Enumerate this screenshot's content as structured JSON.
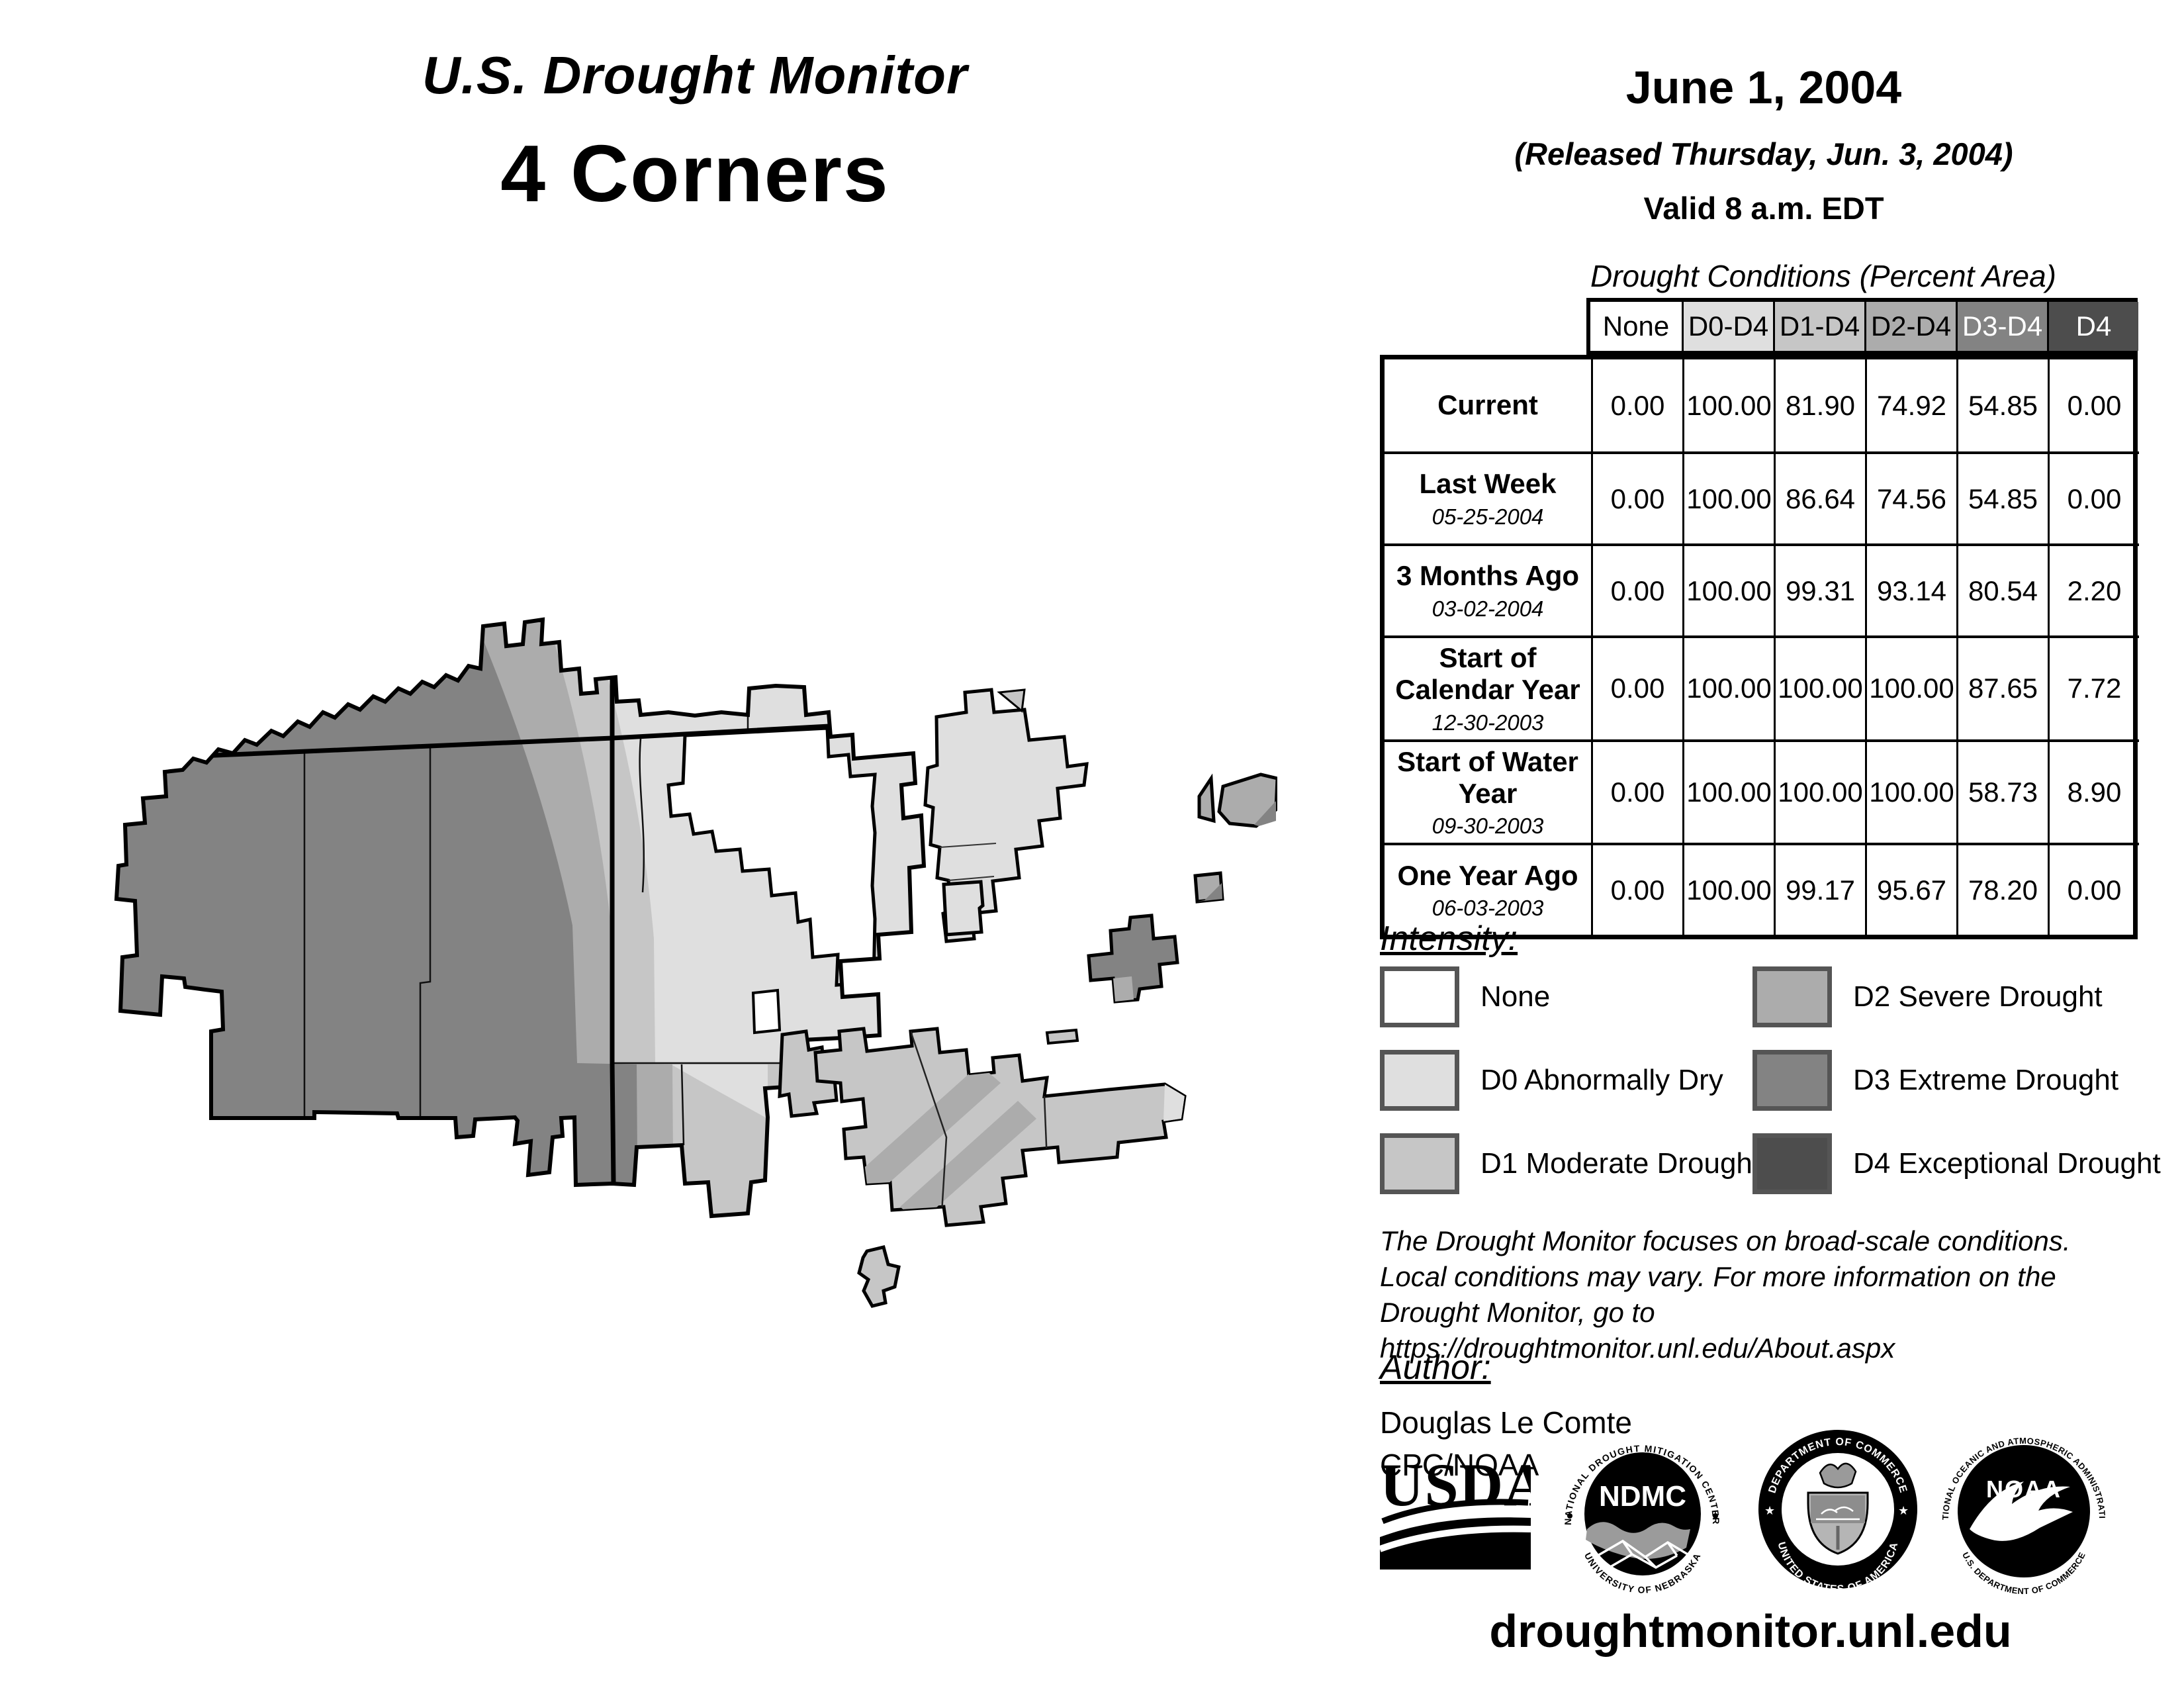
{
  "header": {
    "monitor_title": "U.S. Drought Monitor",
    "region": "4 Corners",
    "date": "June 1, 2004",
    "released": "(Released Thursday, Jun. 3, 2004)",
    "valid": "Valid 8 a.m. EDT"
  },
  "table": {
    "title": "Drought Conditions (Percent Area)",
    "columns": [
      "None",
      "D0-D4",
      "D1-D4",
      "D2-D4",
      "D3-D4",
      "D4"
    ],
    "rows": [
      {
        "label": "Current",
        "date": "",
        "values": [
          "0.00",
          "100.00",
          "81.90",
          "74.92",
          "54.85",
          "0.00"
        ]
      },
      {
        "label": "Last Week",
        "date": "05-25-2004",
        "values": [
          "0.00",
          "100.00",
          "86.64",
          "74.56",
          "54.85",
          "0.00"
        ]
      },
      {
        "label": "3 Months Ago",
        "date": "03-02-2004",
        "values": [
          "0.00",
          "100.00",
          "99.31",
          "93.14",
          "80.54",
          "2.20"
        ]
      },
      {
        "label": "Start of Calendar Year",
        "date": "12-30-2003",
        "values": [
          "0.00",
          "100.00",
          "100.00",
          "100.00",
          "87.65",
          "7.72"
        ]
      },
      {
        "label": "Start of Water Year",
        "date": "09-30-2003",
        "values": [
          "0.00",
          "100.00",
          "100.00",
          "100.00",
          "58.73",
          "8.90"
        ]
      },
      {
        "label": "One Year Ago",
        "date": "06-03-2003",
        "values": [
          "0.00",
          "100.00",
          "99.17",
          "95.67",
          "78.20",
          "0.00"
        ]
      }
    ]
  },
  "legend": {
    "heading": "Intensity:",
    "items": [
      {
        "label": "None"
      },
      {
        "label": "D0 Abnormally Dry"
      },
      {
        "label": "D1 Moderate Drought"
      },
      {
        "label": "D2 Severe Drought"
      },
      {
        "label": "D3 Extreme Drought"
      },
      {
        "label": "D4 Exceptional Drought"
      }
    ]
  },
  "notes": {
    "line1": "The Drought Monitor focuses on broad-scale conditions.",
    "line2": "Local conditions may vary. For more information on the",
    "line3": "Drought Monitor, go to https://droughtmonitor.unl.edu/About.aspx"
  },
  "author": {
    "heading": "Author:",
    "name": "Douglas Le Comte",
    "org": "CPC/NOAA"
  },
  "footer": {
    "url": "droughtmonitor.unl.edu"
  },
  "logos": {
    "usda": {
      "name": "USDA"
    },
    "ndmc": {
      "abbr": "NDMC",
      "ring_top": "NATIONAL DROUGHT MITIGATION CENTER",
      "ring_bottom": "UNIVERSITY OF NEBRASKA"
    },
    "commerce": {
      "ring_top": "DEPARTMENT OF COMMERCE",
      "ring_bottom": "UNITED STATES OF AMERICA"
    },
    "noaa": {
      "abbr": "NOAA",
      "ring_top": "NATIONAL OCEANIC AND ATMOSPHERIC ADMINISTRATION",
      "ring_bottom": "U.S. DEPARTMENT OF COMMERCE"
    }
  },
  "colors": {
    "none": "#ffffff",
    "d0": "#dfdfdf",
    "d1": "#c6c6c6",
    "d2": "#acacac",
    "d3": "#838383",
    "d4": "#4d4d4d",
    "swatch_border": "#555555",
    "map_outline": "#000000"
  }
}
